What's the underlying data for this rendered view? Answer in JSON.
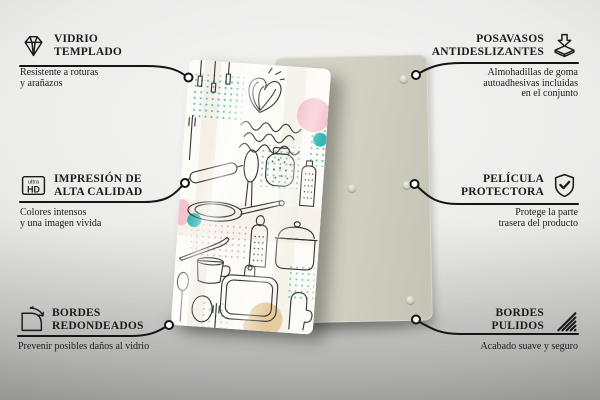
{
  "scene": {
    "front_board_print": "kitchen utensils doodle pattern with pastel accents",
    "back_board": "plain board with self-adhesive rubber pads"
  },
  "callouts": {
    "tempered_glass": {
      "icon": "diamond-icon",
      "title": "VIDRIO\nTEMPLADO",
      "description": "Resistente a roturas\ny arañazos"
    },
    "antislip_coasters": {
      "icon": "coaster-pad-icon",
      "title": "POSAVASOS\nANTIDESLIZANTES",
      "description": "Almohadillas de goma\nautoadhesivas incluidas\nen el conjunto"
    },
    "high_quality_print": {
      "icon": "ultra-hd-icon",
      "icon_label_top": "ultra",
      "icon_label_bottom": "HD",
      "title": "IMPRESIÓN DE\nALTA CALIDAD",
      "description": "Colores intensos\ny una imagen vivida"
    },
    "protective_film": {
      "icon": "shield-check-icon",
      "title": "PELÍCULA\nPROTECTORA",
      "description": "Protege la parte\ntrasera del producto"
    },
    "rounded_edges": {
      "icon": "rounded-corner-icon",
      "title": "BORDES\nREDONDEADOS",
      "description": "Prevenir posibles daños al vidrio"
    },
    "polished_edges": {
      "icon": "polished-edge-icon",
      "title": "BORDES\nPULIDOS",
      "description": "Acabado suave y seguro"
    }
  },
  "colors": {
    "text": "#1b1b1b",
    "connector_line": "#151515",
    "back_board": "#d3d1c4",
    "print_teal": "#2fb7b4",
    "print_pink": "#f5c3cd",
    "print_tan": "#e6cb9f"
  }
}
